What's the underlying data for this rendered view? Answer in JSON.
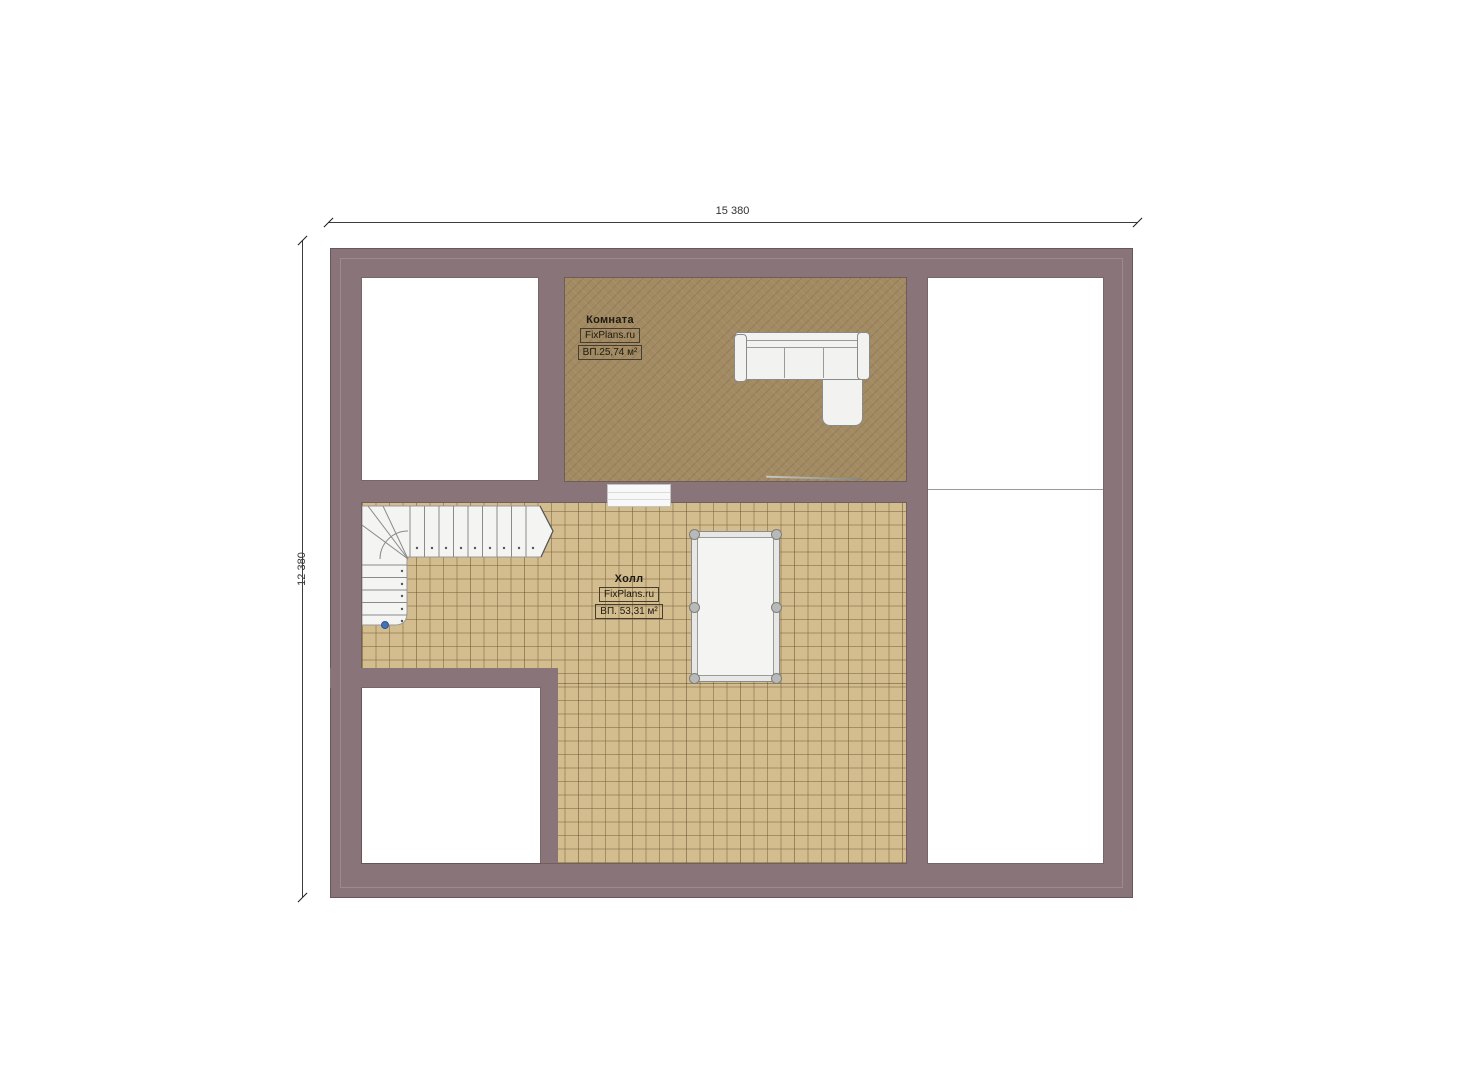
{
  "colors": {
    "background": "#ffffff",
    "wall": "#897579",
    "carpet": "#a28a62",
    "tile": "#d3bc8d",
    "stair_marker": "#4472b8"
  },
  "dimensions": {
    "top_label": "15 380",
    "left_label": "12 380"
  },
  "rooms": {
    "komnata": {
      "name": "Комната",
      "brand": "FixPlans.ru",
      "area": "ВП.25,74 м²"
    },
    "hall": {
      "name": "Холл",
      "brand": "FixPlans.ru",
      "area": "ВП. 53,31 м²"
    }
  }
}
